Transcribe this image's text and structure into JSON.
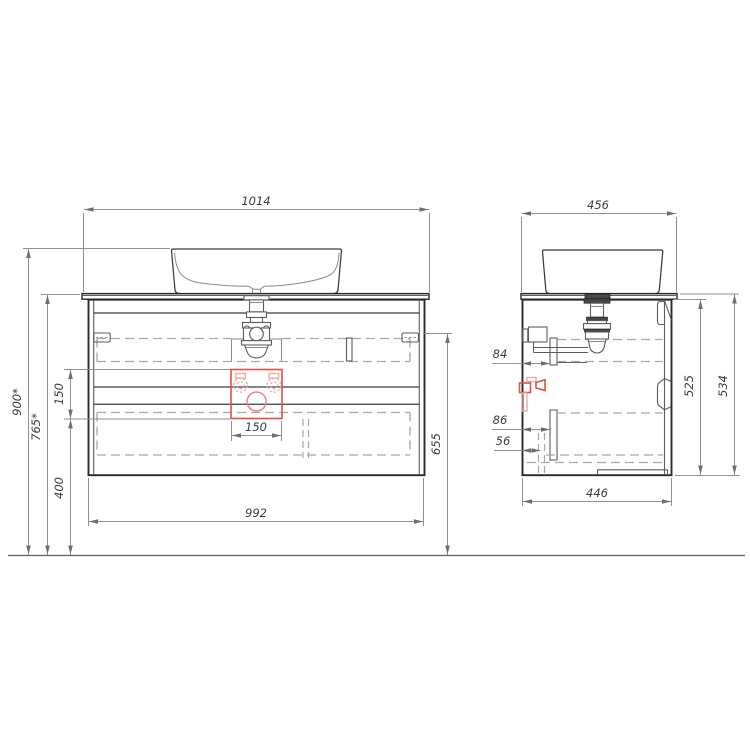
{
  "front_view": {
    "dim_counter_width": "1014",
    "dim_cabinet_width": "992",
    "dim_mount_height": "655",
    "dim_recess_width": "150",
    "dim_recess_height": "150",
    "dim_total_height": "900*",
    "dim_counter_height": "765*",
    "dim_under_clearance": "400"
  },
  "side_view": {
    "dim_counter_depth": "456",
    "dim_cabinet_depth": "446",
    "dim_cabinet_height": "525",
    "dim_total_height": "534",
    "dim_offset_pipe": "84",
    "dim_offset_drawer": "86",
    "dim_offset_bracket": "56"
  },
  "colors": {
    "accent_red": "#dd5146",
    "accent_red_light": "#eda49c",
    "outline": "#2a2a2a",
    "dim_line": "#909090",
    "hidden_line": "#a8a8a8"
  }
}
